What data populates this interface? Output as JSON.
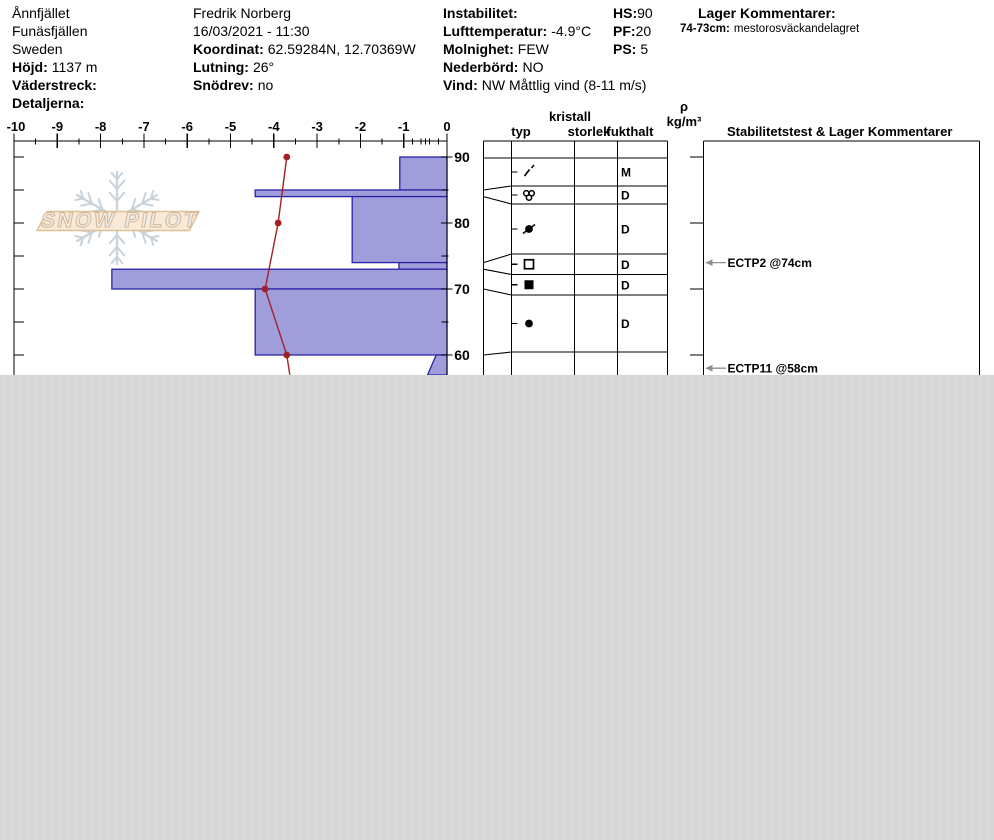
{
  "header": {
    "location": {
      "name": "Ånnfjället",
      "area": "Funäsfjällen",
      "country": "Sweden",
      "elev_label": "Höjd:",
      "elev": "1137 m",
      "aspect_label": "Väderstreck:",
      "details_label": "Detaljerna:"
    },
    "observer": {
      "name": "Fredrik Norberg",
      "datetime": "16/03/2021 - 11:30",
      "coord_label": "Koordinat:",
      "coord": "62.59284N, 12.70369W",
      "slope_label": "Lutning:",
      "slope": "26°",
      "drift_label": "Snödrev:",
      "drift": "no"
    },
    "weather": {
      "instability_label": "Instabilitet:",
      "airtemp_label": "Lufttemperatur:",
      "airtemp": "-4.9°C",
      "sky_label": "Molnighet:",
      "sky": "FEW",
      "precip_label": "Nederbörd:",
      "precip": "NO",
      "wind_label": "Vind:",
      "wind": "NW Måttlig vind (8-11 m/s)"
    },
    "totals": {
      "hs_label": "HS:",
      "hs": "90",
      "pf_label": "PF:",
      "pf": "20",
      "ps_label": "PS:",
      "ps": "5"
    },
    "layer_comments": {
      "title": "Lager Kommentarer:",
      "entry_range": "74-73cm:",
      "entry_text": "mestorosväckandelagret"
    }
  },
  "table_headers": {
    "typ": "typ",
    "kristall": "kristall",
    "storlek": "storlek",
    "fukthalt": "fukthalt",
    "rho": "ρ",
    "rho_unit": "kg/m³",
    "stability": "Stabilitetstest & Lager Kommentarer"
  },
  "watermark": "SNOW PILOT",
  "chart_data": {
    "type": "snow-profile",
    "temp_axis": {
      "min": -10,
      "max": 0,
      "step": 1,
      "unit": "°C",
      "position": "top",
      "minor_step": 0.5,
      "fine_ticks": [
        -0.8,
        -0.6,
        -0.4,
        -0.2
      ]
    },
    "depth_axis": {
      "unit": "cm",
      "major_labels": [
        90,
        80,
        70,
        60
      ],
      "tick_step": 5,
      "surface": 90,
      "visible_bottom": 57
    },
    "temperature_profile": [
      {
        "depth": 90,
        "temp": -3.7
      },
      {
        "depth": 80,
        "temp": -3.9
      },
      {
        "depth": 70,
        "temp": -4.2
      },
      {
        "depth": 60,
        "temp": -3.7
      },
      {
        "depth": 57,
        "temp": -3.63,
        "marker": false
      }
    ],
    "layers": [
      {
        "top": 90,
        "bottom": 85,
        "bar_units": 1.09,
        "grain": "decomposing-fragments",
        "glyph": "slash",
        "moisture": "M",
        "row": [
          158,
          186
        ]
      },
      {
        "top": 85,
        "bottom": 84,
        "bar_units": 4.43,
        "grain": "melt-form-clusters",
        "glyph": "circle-cluster",
        "moisture": "D",
        "row": [
          186,
          204
        ]
      },
      {
        "top": 84,
        "bottom": 74,
        "bar_units": 2.19,
        "grain": "melt-freeze-crust",
        "glyph": "filled-circle-slash",
        "moisture": "D",
        "row": [
          204,
          254
        ]
      },
      {
        "top": 74,
        "bottom": 73,
        "bar_units": 1.11,
        "grain": "faceted-crystals",
        "glyph": "hollow-square",
        "moisture": "D",
        "row": [
          254,
          274.5
        ]
      },
      {
        "top": 73,
        "bottom": 70,
        "bar_units": 7.74,
        "grain": "hard-slab",
        "glyph": "filled-square",
        "moisture": "D",
        "row": [
          274.5,
          295
        ]
      },
      {
        "top": 70,
        "bottom": 60,
        "bar_units": 4.43,
        "grain": "rounded-grains",
        "glyph": "filled-circle",
        "moisture": "D",
        "row": [
          295,
          352
        ]
      },
      {
        "top": 60,
        "bottom": 57,
        "bar_units": 0.25,
        "bar_units_bottom": 0.45,
        "grain": "",
        "glyph": "",
        "moisture": "",
        "row": [
          352,
          375
        ],
        "clipped": true
      }
    ],
    "tests": [
      {
        "label": "ECTP2 @74cm",
        "depth": 74
      },
      {
        "label": "ECTP11 @58cm",
        "depth": 58
      }
    ],
    "colors": {
      "bar_fill": "#9f9eda",
      "bar_stroke": "#2822a5",
      "temp_line": "#a32125",
      "grid": "#000000",
      "arrow": "#8f8f8f",
      "flake": "#c7d2db",
      "banner_fill": "#f7ead8",
      "banner_stroke": "#dcc09a",
      "banner_text_fill": "#e8edf2",
      "banner_text_stroke": "#dcb48c",
      "cutoff_bg": "#d7d7d7"
    }
  }
}
